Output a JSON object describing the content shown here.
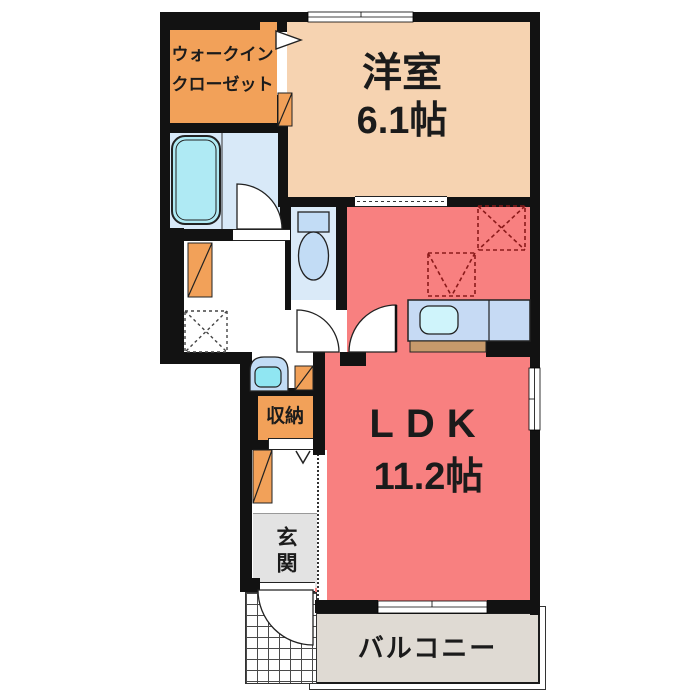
{
  "plan_title": "1LDK apartment floor plan",
  "rooms": {
    "walk_in_closet": {
      "label_line1": "ウォークイン",
      "label_line2": "クローゼット"
    },
    "western_room": {
      "name": "洋室",
      "size": "6.1帖"
    },
    "ldk": {
      "name": "LDK",
      "size": "11.2帖"
    },
    "storage": {
      "label": "収納"
    },
    "entrance": {
      "label": "玄関"
    },
    "balcony": {
      "label": "バルコニー"
    }
  },
  "fixtures": [
    "bathtub",
    "toilet",
    "washbasin",
    "kitchen-sink",
    "kitchen-counter",
    "refrigerator-space",
    "appliance-space",
    "washer-space",
    "entrance-door-swing",
    "bath-door-swing",
    "toilet-door-swing",
    "ldk-door-swing",
    "porch-tiles",
    "windows"
  ],
  "colors": {
    "wall": "#121212",
    "western": "#F6D3B1",
    "ldk": "#F88080",
    "closet": "#F2A159",
    "bath_floor": "#D8E9F8",
    "bathtub": "#AFEAF4",
    "toilet_floor": "#DAEAF8",
    "fixture": "#C2DCF5",
    "basin": "#90E6F2",
    "sink": "#CFF4FB",
    "counter": "#C6DAF4",
    "wood": "#C79A6B",
    "genkan": "#E3E3E3",
    "balcony": "#DFDAD3",
    "dashed": "#8B1A1A"
  }
}
